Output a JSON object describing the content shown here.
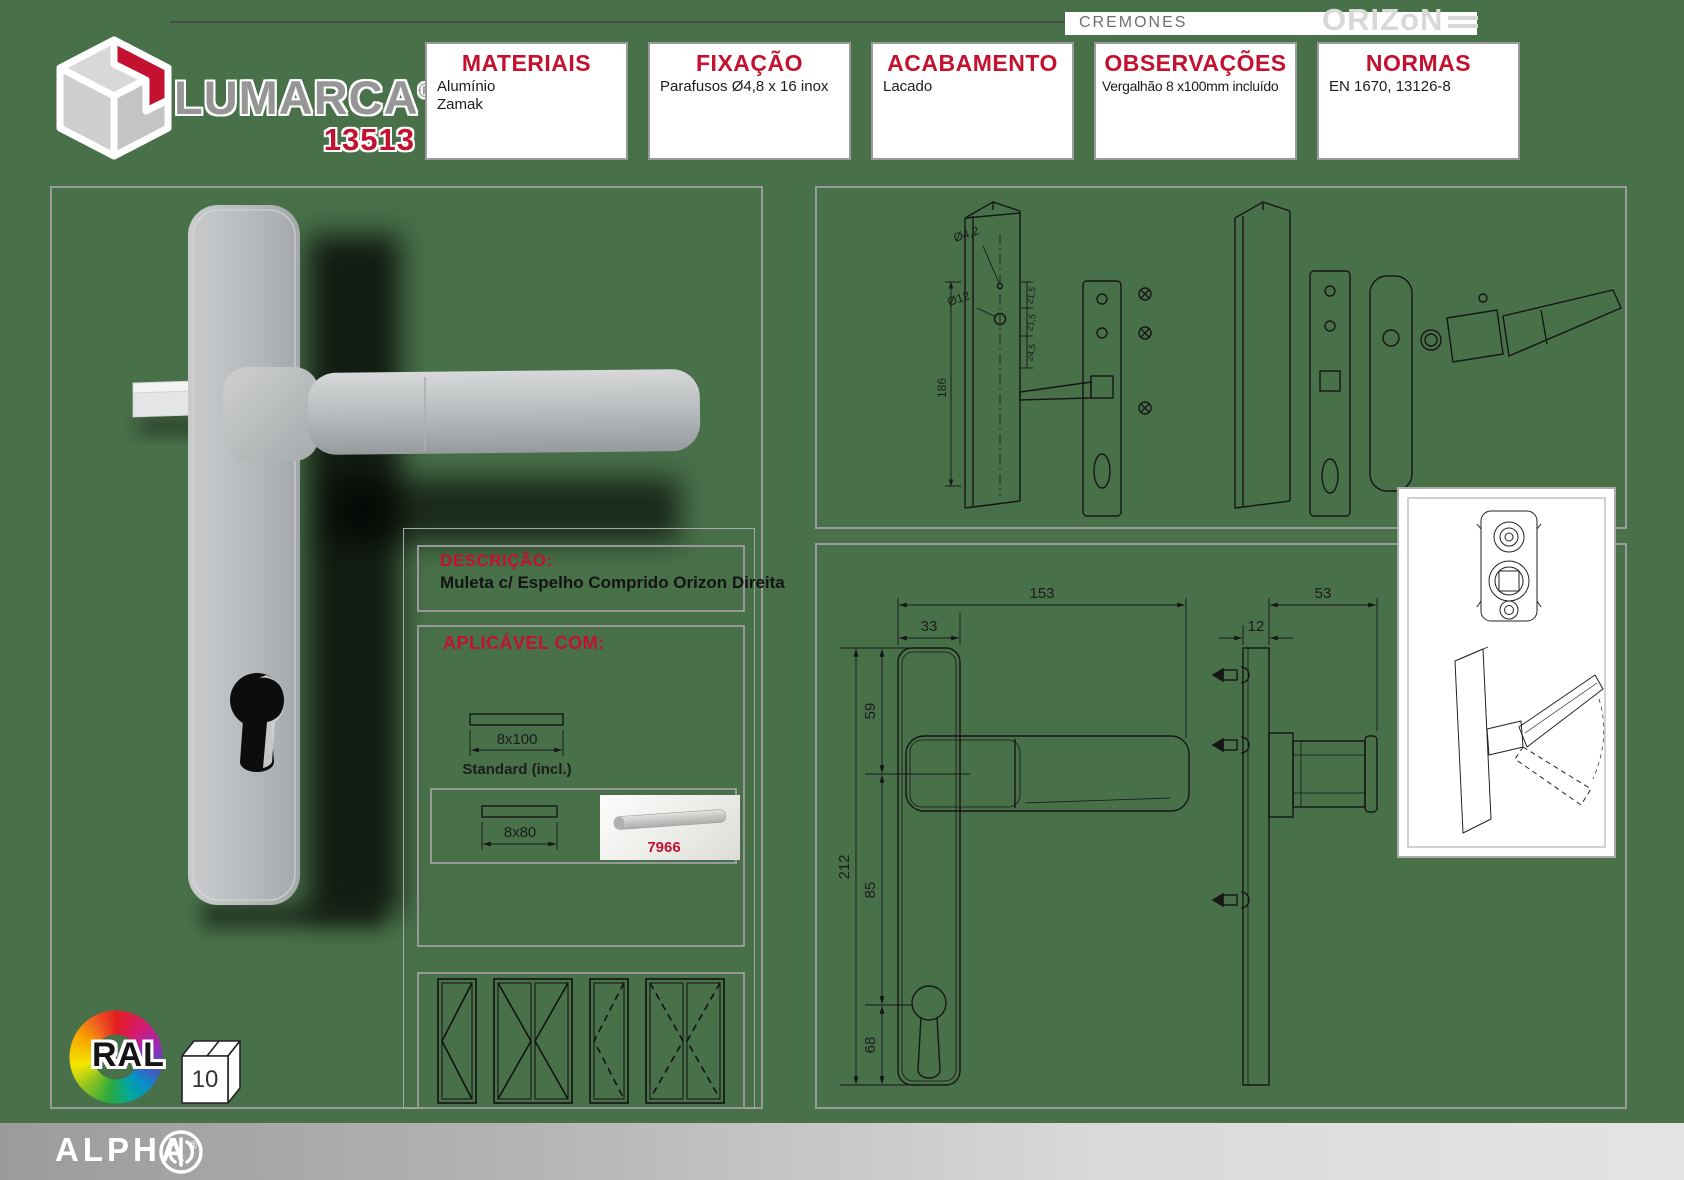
{
  "colors": {
    "background_green": "#487049",
    "accent_red": "#c3112f",
    "brand_gray": "#969696"
  },
  "header": {
    "brand_name": "LUMARCA",
    "brand_reg": "®",
    "brand_code": "13513",
    "category": "CREMONES",
    "partner_brand": "ORIZoN"
  },
  "info_boxes": [
    {
      "title": "MATERIAIS",
      "lines": [
        "Alumínio",
        "Zamak"
      ]
    },
    {
      "title": "FIXAÇÃO",
      "lines": [
        "Parafusos Ø4,8 x 16 inox"
      ]
    },
    {
      "title": "ACABAMENTO",
      "lines": [
        "Lacado"
      ]
    },
    {
      "title": "OBSERVAÇÕES",
      "lines": [
        "Vergalhão 8 x100mm incluído"
      ]
    },
    {
      "title": "NORMAS",
      "lines": [
        "EN 1670, 13126-8"
      ]
    }
  ],
  "description": {
    "label": "DESCRIÇÃO:",
    "text": "Muleta c/ Espelho Comprido Orizon Direita"
  },
  "aplicavel": {
    "label": "APLICÁVEL COM:",
    "rod_standard": {
      "dim": "8x100",
      "note": "Standard (incl.)"
    },
    "rod_optional": {
      "dim": "8x80",
      "code": "7966"
    }
  },
  "drawings": {
    "exploded": {
      "hole_small": "Ø4,2",
      "hole_big": "Ø12",
      "height": "186",
      "seg1": "21,5",
      "seg2": "21,5",
      "seg3": "24,5"
    },
    "front": {
      "width": "153",
      "plate_width": "33",
      "top_offset": "59",
      "handle_to_cylinder": "85",
      "cylinder_to_bottom": "68",
      "height": "212"
    },
    "side": {
      "depth": "53",
      "plate_thickness": "12"
    }
  },
  "footer": {
    "ral_label": "RAL",
    "package_qty": "10",
    "alpha_label": "ALPHA",
    "alpha_reg": "®"
  }
}
